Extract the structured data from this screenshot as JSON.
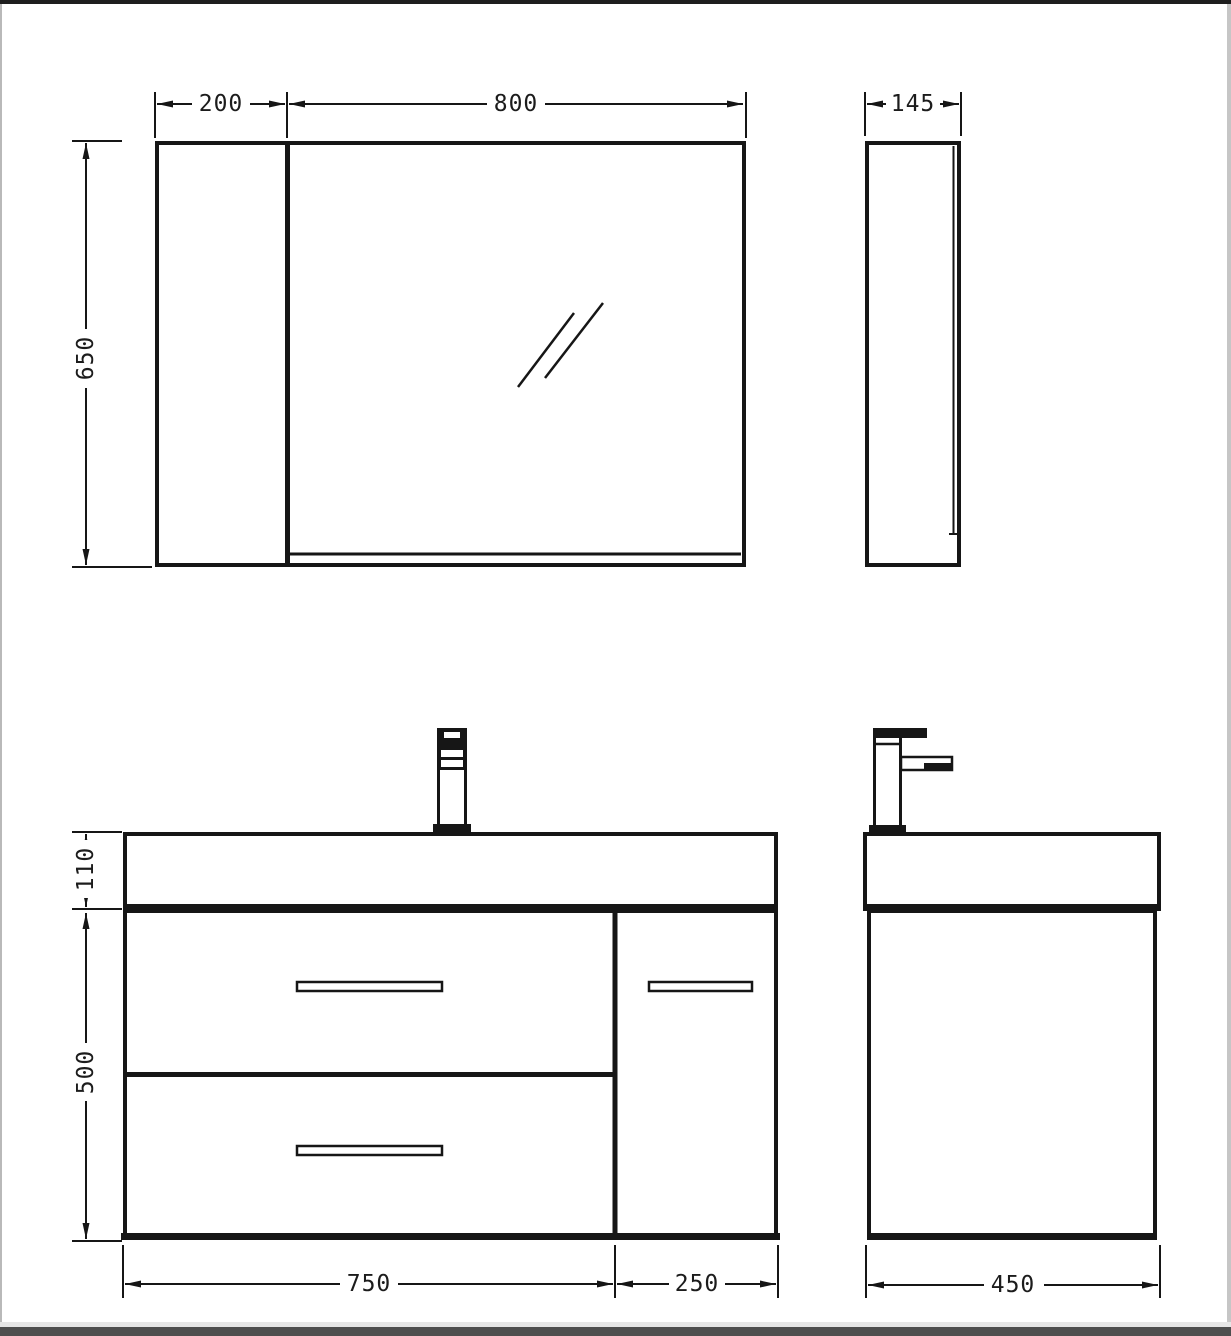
{
  "dims": {
    "mirror_left_width": "200",
    "mirror_glass_width": "800",
    "mirror_height": "650",
    "mirror_depth": "145",
    "basin_height": "110",
    "cabinet_height": "500",
    "drawer_section_width": "750",
    "door_section_width": "250",
    "cabinet_depth": "450"
  },
  "colors": {
    "line": "#161616",
    "background": "#ffffff",
    "right_edge_gray": "#c6c6c6",
    "bottom_band_light": "#e6e6e6",
    "bottom_band_dark": "#4e4e4e",
    "top_band_dark": "#1e1e1e"
  }
}
